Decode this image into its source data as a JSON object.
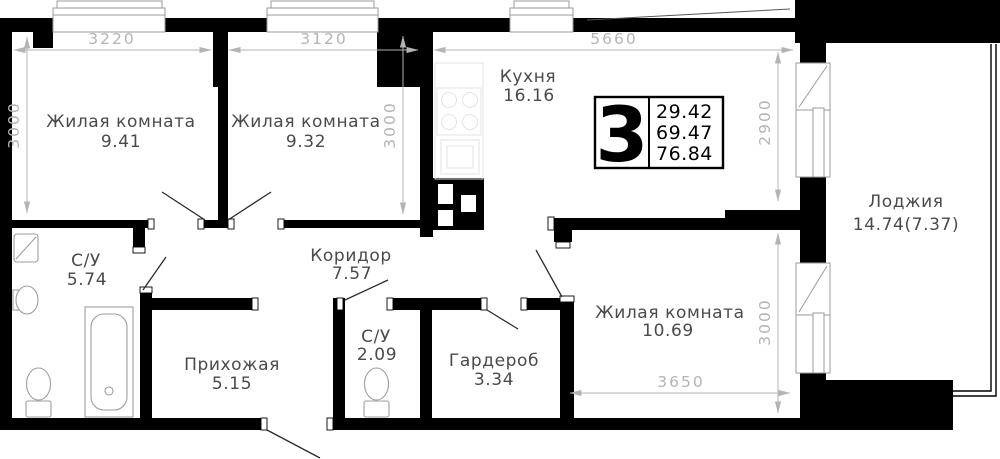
{
  "plan": {
    "rooms": [
      {
        "name": "Жилая комната",
        "area": "9.41"
      },
      {
        "name": "Жилая комната",
        "area": "9.32"
      },
      {
        "name": "Кухня",
        "area": "16.16"
      },
      {
        "name": "С/У",
        "area": "5.74"
      },
      {
        "name": "Коридор",
        "area": "7.57"
      },
      {
        "name": "Прихожая",
        "area": "5.15"
      },
      {
        "name": "С/У",
        "area": "2.09"
      },
      {
        "name": "Гардероб",
        "area": "3.34"
      },
      {
        "name": "Жилая комната",
        "area": "10.69"
      },
      {
        "name": "Лоджия",
        "area": "14.74(7.37)"
      }
    ],
    "badge": {
      "rooms": "3",
      "values": [
        "29.42",
        "69.47",
        "76.84"
      ]
    },
    "dims": {
      "room1_width": "3220",
      "room2_width": "3120",
      "kitchen_width": "5660",
      "room1_height": "3000",
      "room2_height": "3000",
      "kitchen_height": "2900",
      "room3_height": "3000",
      "room3_width": "3650"
    },
    "colors": {
      "wall": "#000000",
      "dim_text": "#b4b4b4",
      "label_text": "#4a4a4a",
      "fixture": "#9e9e9e"
    }
  }
}
